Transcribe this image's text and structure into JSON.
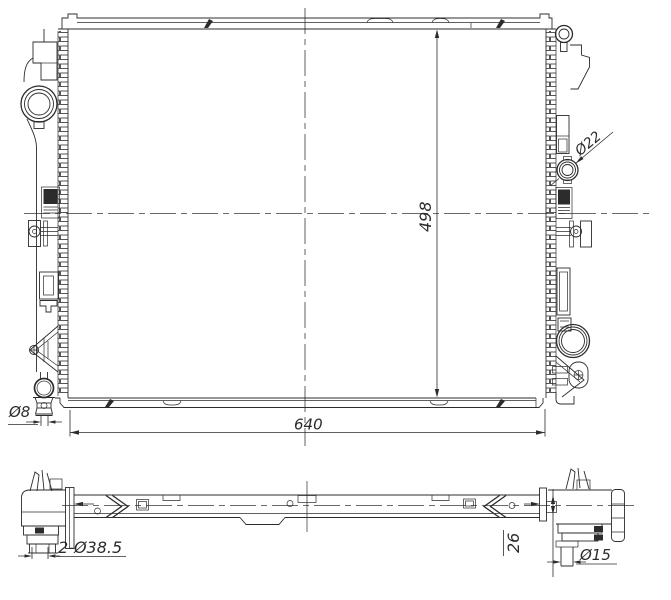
{
  "drawing": {
    "kind": "radiator technical drawing",
    "views": {
      "front": "front-view",
      "bottom": "bottom-view"
    },
    "colors": {
      "line": "#2c2c2c",
      "background": "#ffffff"
    },
    "labels": {
      "core_height": "498",
      "core_width": "640",
      "port_diameter": "Ø22",
      "drain_diameter": "Ø8",
      "inlet_diameter": "2-Ø38.5",
      "offset": "26",
      "outlet_diameter": "Ø15"
    }
  }
}
